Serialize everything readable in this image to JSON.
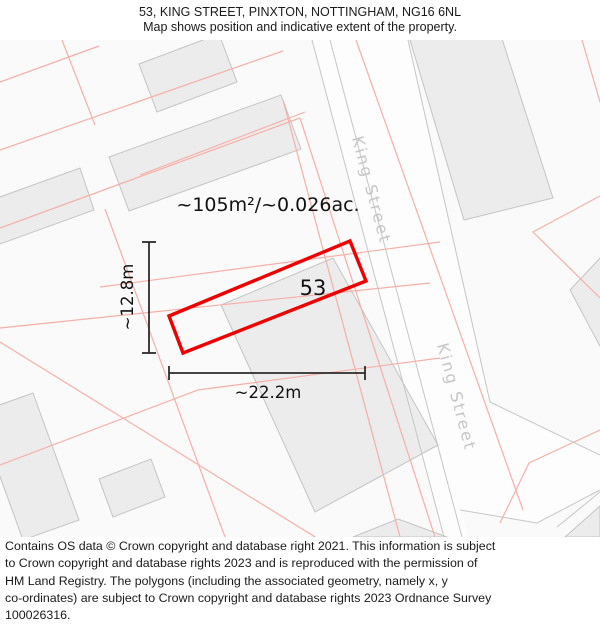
{
  "header": {
    "title": "53, KING STREET, PINXTON, NOTTINGHAM, NG16 6NL",
    "subtitle": "Map shows position and indicative extent of the property."
  },
  "map": {
    "street_name": "King Street",
    "plot_number": "53",
    "area_label": "~105m²/~0.026ac.",
    "width_label": "~22.2m",
    "height_label": "~12.8m",
    "colors": {
      "plot_outline": "#ee0000",
      "parcel_line": "#f6afa7",
      "building_fill": "#ececec",
      "building_stroke": "#c4c4c4",
      "road_fill": "#fdfdfd",
      "road_edge": "#c6c6c6",
      "street_text": "#c6c6c6",
      "dimension": "#2b2b2b",
      "label_text": "#111111",
      "map_background": "#fafafa"
    }
  },
  "footer": {
    "lines": [
      "Contains OS data © Crown copyright and database right 2021. This information is subject",
      "to Crown copyright and database rights 2023 and is reproduced with the permission of",
      "HM Land Registry. The polygons (including the associated geometry, namely x, y",
      "co-ordinates) are subject to Crown copyright and database rights 2023 Ordnance Survey",
      "100026316."
    ]
  }
}
